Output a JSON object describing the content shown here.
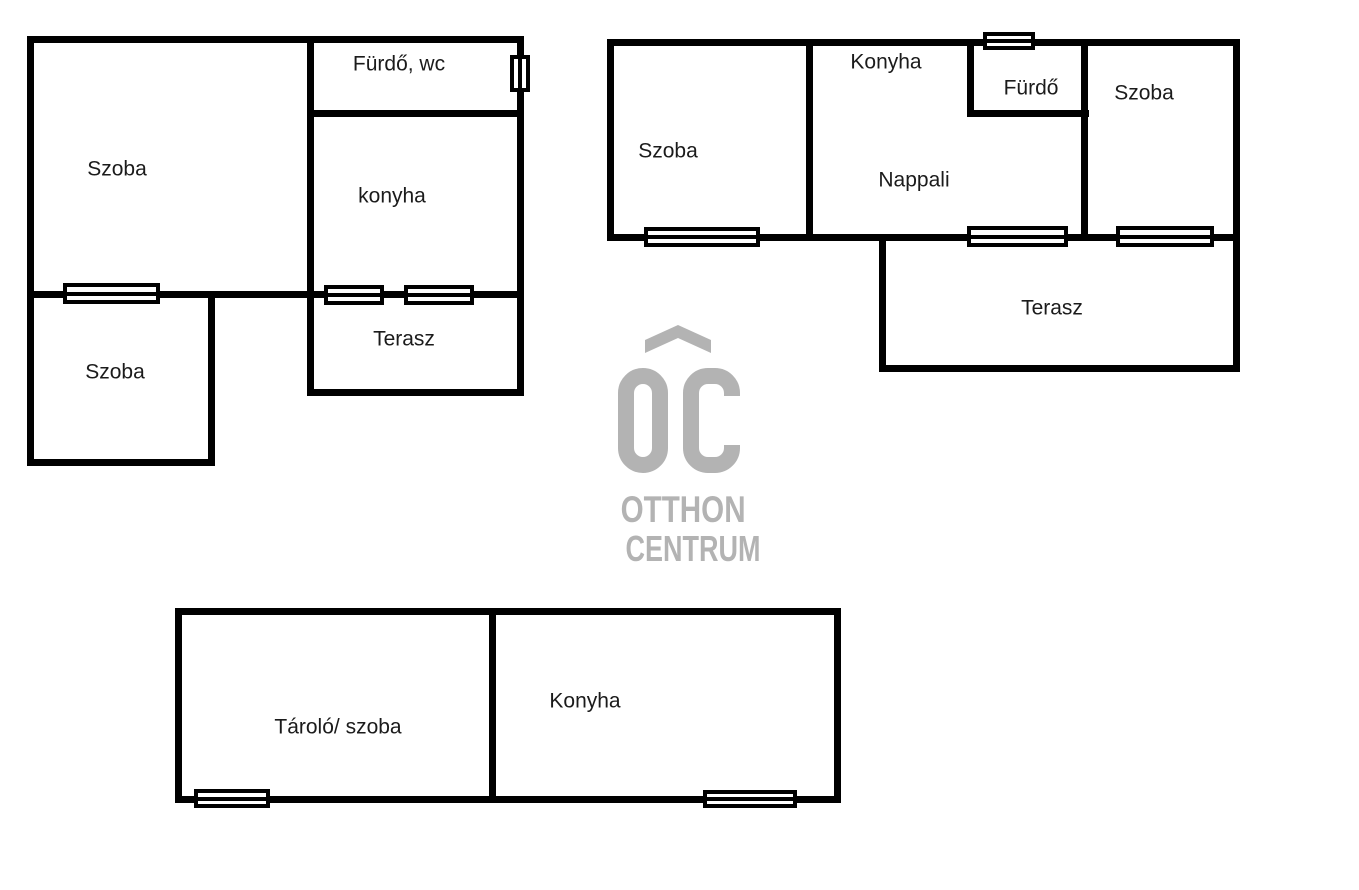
{
  "canvas": {
    "width_px": 1359,
    "height_px": 890,
    "background": "#ffffff"
  },
  "colors": {
    "wall": "#000000",
    "room_label": "#1b1b1b",
    "window_fill": "#ffffff",
    "watermark_gray": "#b3b3b3"
  },
  "watermark": {
    "monogram": "OC",
    "line1": "OTTHON",
    "line2": "CENTRUM",
    "color": "#b3b3b3"
  },
  "plans": [
    {
      "id": "top-left-unit",
      "rooms": [
        {
          "label": "Szoba",
          "cx": 117,
          "cy": 169
        },
        {
          "label": "Fürdő, wc",
          "cx": 399,
          "cy": 64
        },
        {
          "label": "konyha",
          "cx": 392,
          "cy": 196
        },
        {
          "label": "Terasz",
          "cx": 404,
          "cy": 339
        },
        {
          "label": "Szoba",
          "cx": 115,
          "cy": 372
        }
      ],
      "walls": [
        {
          "x": 27,
          "y": 36,
          "w": 497,
          "h": 7
        },
        {
          "x": 27,
          "y": 36,
          "w": 7,
          "h": 430
        },
        {
          "x": 517,
          "y": 36,
          "w": 7,
          "h": 360
        },
        {
          "x": 307,
          "y": 36,
          "w": 7,
          "h": 360
        },
        {
          "x": 307,
          "y": 110,
          "w": 217,
          "h": 7
        },
        {
          "x": 27,
          "y": 291,
          "w": 497,
          "h": 7
        },
        {
          "x": 208,
          "y": 291,
          "w": 7,
          "h": 175
        },
        {
          "x": 27,
          "y": 459,
          "w": 188,
          "h": 7
        },
        {
          "x": 307,
          "y": 389,
          "w": 217,
          "h": 7
        }
      ],
      "windows": [
        {
          "x": 63,
          "y": 283,
          "w": 97,
          "h": 21,
          "orientation": "h"
        },
        {
          "x": 324,
          "y": 285,
          "w": 60,
          "h": 20,
          "orientation": "h"
        },
        {
          "x": 404,
          "y": 285,
          "w": 70,
          "h": 20,
          "orientation": "h"
        },
        {
          "x": 510,
          "y": 55,
          "w": 20,
          "h": 37,
          "orientation": "v"
        }
      ]
    },
    {
      "id": "top-right-unit",
      "rooms": [
        {
          "label": "Szoba",
          "cx": 668,
          "cy": 151
        },
        {
          "label": "Konyha",
          "cx": 886,
          "cy": 62
        },
        {
          "label": "Fürdő",
          "cx": 1031,
          "cy": 88
        },
        {
          "label": "Szoba",
          "cx": 1144,
          "cy": 93
        },
        {
          "label": "Nappali",
          "cx": 914,
          "cy": 180
        },
        {
          "label": "Terasz",
          "cx": 1052,
          "cy": 308
        }
      ],
      "walls": [
        {
          "x": 607,
          "y": 39,
          "w": 633,
          "h": 7
        },
        {
          "x": 607,
          "y": 39,
          "w": 7,
          "h": 202
        },
        {
          "x": 607,
          "y": 234,
          "w": 633,
          "h": 7
        },
        {
          "x": 806,
          "y": 39,
          "w": 7,
          "h": 202
        },
        {
          "x": 967,
          "y": 39,
          "w": 7,
          "h": 78
        },
        {
          "x": 967,
          "y": 110,
          "w": 122,
          "h": 7
        },
        {
          "x": 1081,
          "y": 39,
          "w": 7,
          "h": 202
        },
        {
          "x": 1233,
          "y": 39,
          "w": 7,
          "h": 333
        },
        {
          "x": 879,
          "y": 241,
          "w": 7,
          "h": 131
        },
        {
          "x": 879,
          "y": 365,
          "w": 361,
          "h": 7
        }
      ],
      "windows": [
        {
          "x": 644,
          "y": 227,
          "w": 116,
          "h": 20,
          "orientation": "h"
        },
        {
          "x": 967,
          "y": 226,
          "w": 101,
          "h": 21,
          "orientation": "h"
        },
        {
          "x": 1116,
          "y": 226,
          "w": 98,
          "h": 21,
          "orientation": "h"
        },
        {
          "x": 983,
          "y": 32,
          "w": 52,
          "h": 18,
          "orientation": "h"
        }
      ]
    },
    {
      "id": "bottom-unit",
      "rooms": [
        {
          "label": "Tároló/ szoba",
          "cx": 338,
          "cy": 727
        },
        {
          "label": "Konyha",
          "cx": 585,
          "cy": 701
        }
      ],
      "walls": [
        {
          "x": 175,
          "y": 608,
          "w": 666,
          "h": 7
        },
        {
          "x": 175,
          "y": 608,
          "w": 7,
          "h": 195
        },
        {
          "x": 834,
          "y": 608,
          "w": 7,
          "h": 195
        },
        {
          "x": 175,
          "y": 796,
          "w": 666,
          "h": 7
        },
        {
          "x": 489,
          "y": 608,
          "w": 7,
          "h": 195
        }
      ],
      "windows": [
        {
          "x": 194,
          "y": 789,
          "w": 76,
          "h": 19,
          "orientation": "h"
        },
        {
          "x": 703,
          "y": 790,
          "w": 94,
          "h": 18,
          "orientation": "h"
        }
      ]
    }
  ]
}
